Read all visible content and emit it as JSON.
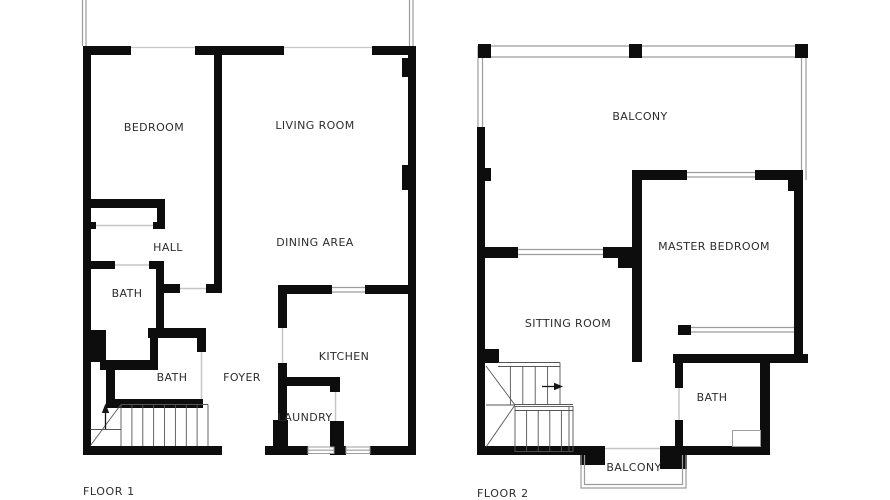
{
  "canvas": {
    "width": 890,
    "height": 500,
    "background": "#ffffff"
  },
  "style": {
    "wall_color": "#0d0d0d",
    "window_line_color": "#9c9c9c",
    "opening_line_color": "#c6c6c6",
    "stair_line_color": "#555555",
    "label_color": "#2d2d2d"
  },
  "floor1": {
    "title": "FLOOR 1",
    "rooms": {
      "bedroom": "BEDROOM",
      "living_room": "LIVING ROOM",
      "hall": "HALL",
      "dining_area": "DINING AREA",
      "bath_upper": "BATH",
      "bath_lower": "BATH",
      "foyer": "FOYER",
      "kitchen": "KITCHEN",
      "laundry": "LAUNDRY"
    }
  },
  "floor2": {
    "title": "FLOOR 2",
    "rooms": {
      "balcony_top": "BALCONY",
      "master_bedroom": "MASTER BEDROOM",
      "sitting_room": "SITTING ROOM",
      "bath": "BATH",
      "balcony_bottom": "BALCONY"
    }
  }
}
